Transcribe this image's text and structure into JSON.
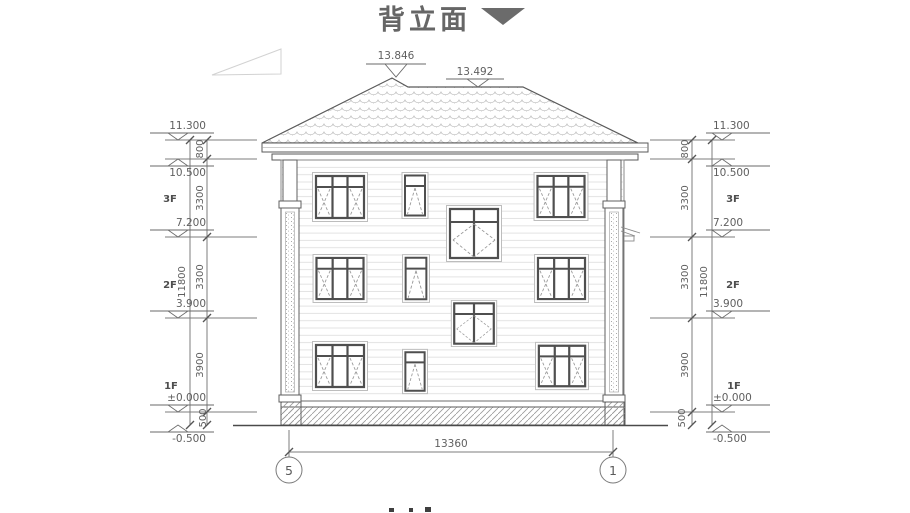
{
  "title": {
    "text": "背立面"
  },
  "roof": {
    "peak_elevation": "13.846",
    "ridge_elevation": "13.492"
  },
  "levels": [
    {
      "label": "11.300"
    },
    {
      "label": "10.500"
    },
    {
      "label": "7.200"
    },
    {
      "label": "3.900"
    },
    {
      "label": "±0.000"
    },
    {
      "label": "-0.500"
    }
  ],
  "floors": [
    {
      "label": "3F"
    },
    {
      "label": "2F"
    },
    {
      "label": "1F"
    }
  ],
  "dims": {
    "segments": [
      {
        "label": "800"
      },
      {
        "label": "3300"
      },
      {
        "label": "3300"
      },
      {
        "label": "3900"
      },
      {
        "label": "500"
      }
    ],
    "overall_height": "11800",
    "overall_width": "13360"
  },
  "grid": {
    "left_bubble": "5",
    "right_bubble": "1"
  },
  "colors": {
    "line": "#6e6e6e",
    "arrow": "#6b6b6b"
  }
}
